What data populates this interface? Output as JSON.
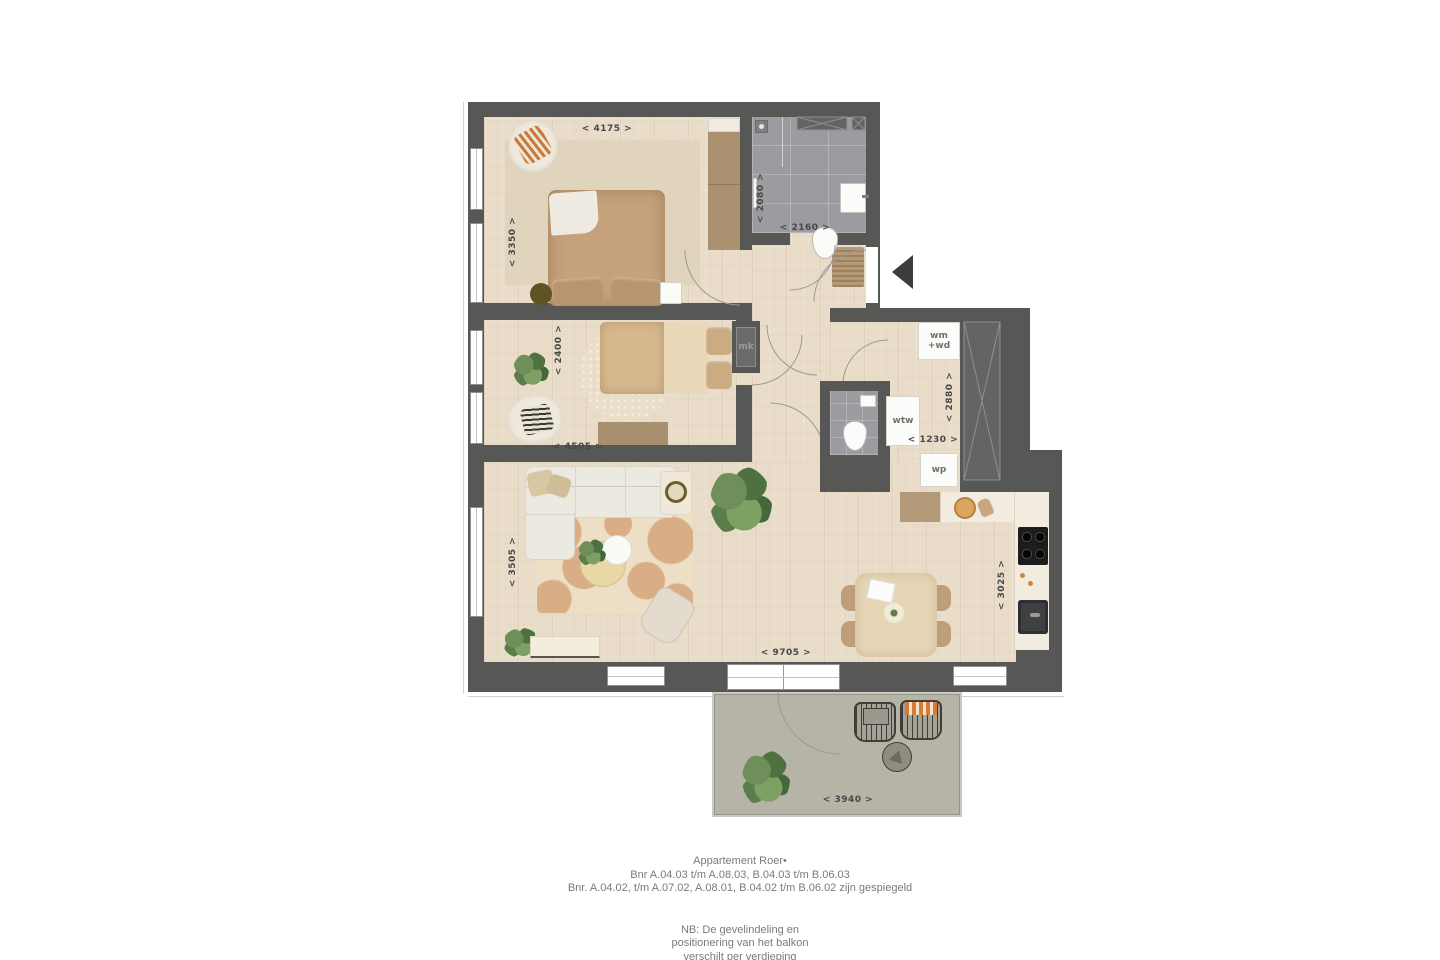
{
  "dims": {
    "bedroom1_w": "< 4175 >",
    "bedroom1_h": "< 3350 >",
    "bath_h": "< 2080 >",
    "bath_w": "< 2160 >",
    "bedroom2_h": "< 2400 >",
    "bedroom2_w": "< 4505 >",
    "tech_h": "< 2880 >",
    "tech_w": "< 1230 >",
    "living_h": "< 3505 >",
    "living_w": "< 9705 >",
    "kitchen_h": "< 3025 >",
    "balcony_w": "< 3940 >"
  },
  "tech_labels": {
    "mk": "mk",
    "wm": "wm",
    "wd": "+wd",
    "wtw": "wtw",
    "wp": "wp"
  },
  "footer": {
    "title": "Appartement Roer•",
    "line2": "Bnr A.04.03 t/m A.08.03, B.04.03 t/m B.06.03",
    "line3": "Bnr. A.04.02, t/m A.07.02, A.08.01, B.04.02 t/m B.06.02 zijn gespiegeld",
    "nb1": "NB: De gevelindeling en",
    "nb2": "positionering van het balkon",
    "nb3": "verschilt per verdieping"
  },
  "colors": {
    "wall": "#575756",
    "wood_floor": "#e9ddca",
    "tile": "#9a9c9f",
    "balcony": "#b6b4a7",
    "dim_text": "#48484a",
    "footer_text": "#7a7a7a"
  }
}
